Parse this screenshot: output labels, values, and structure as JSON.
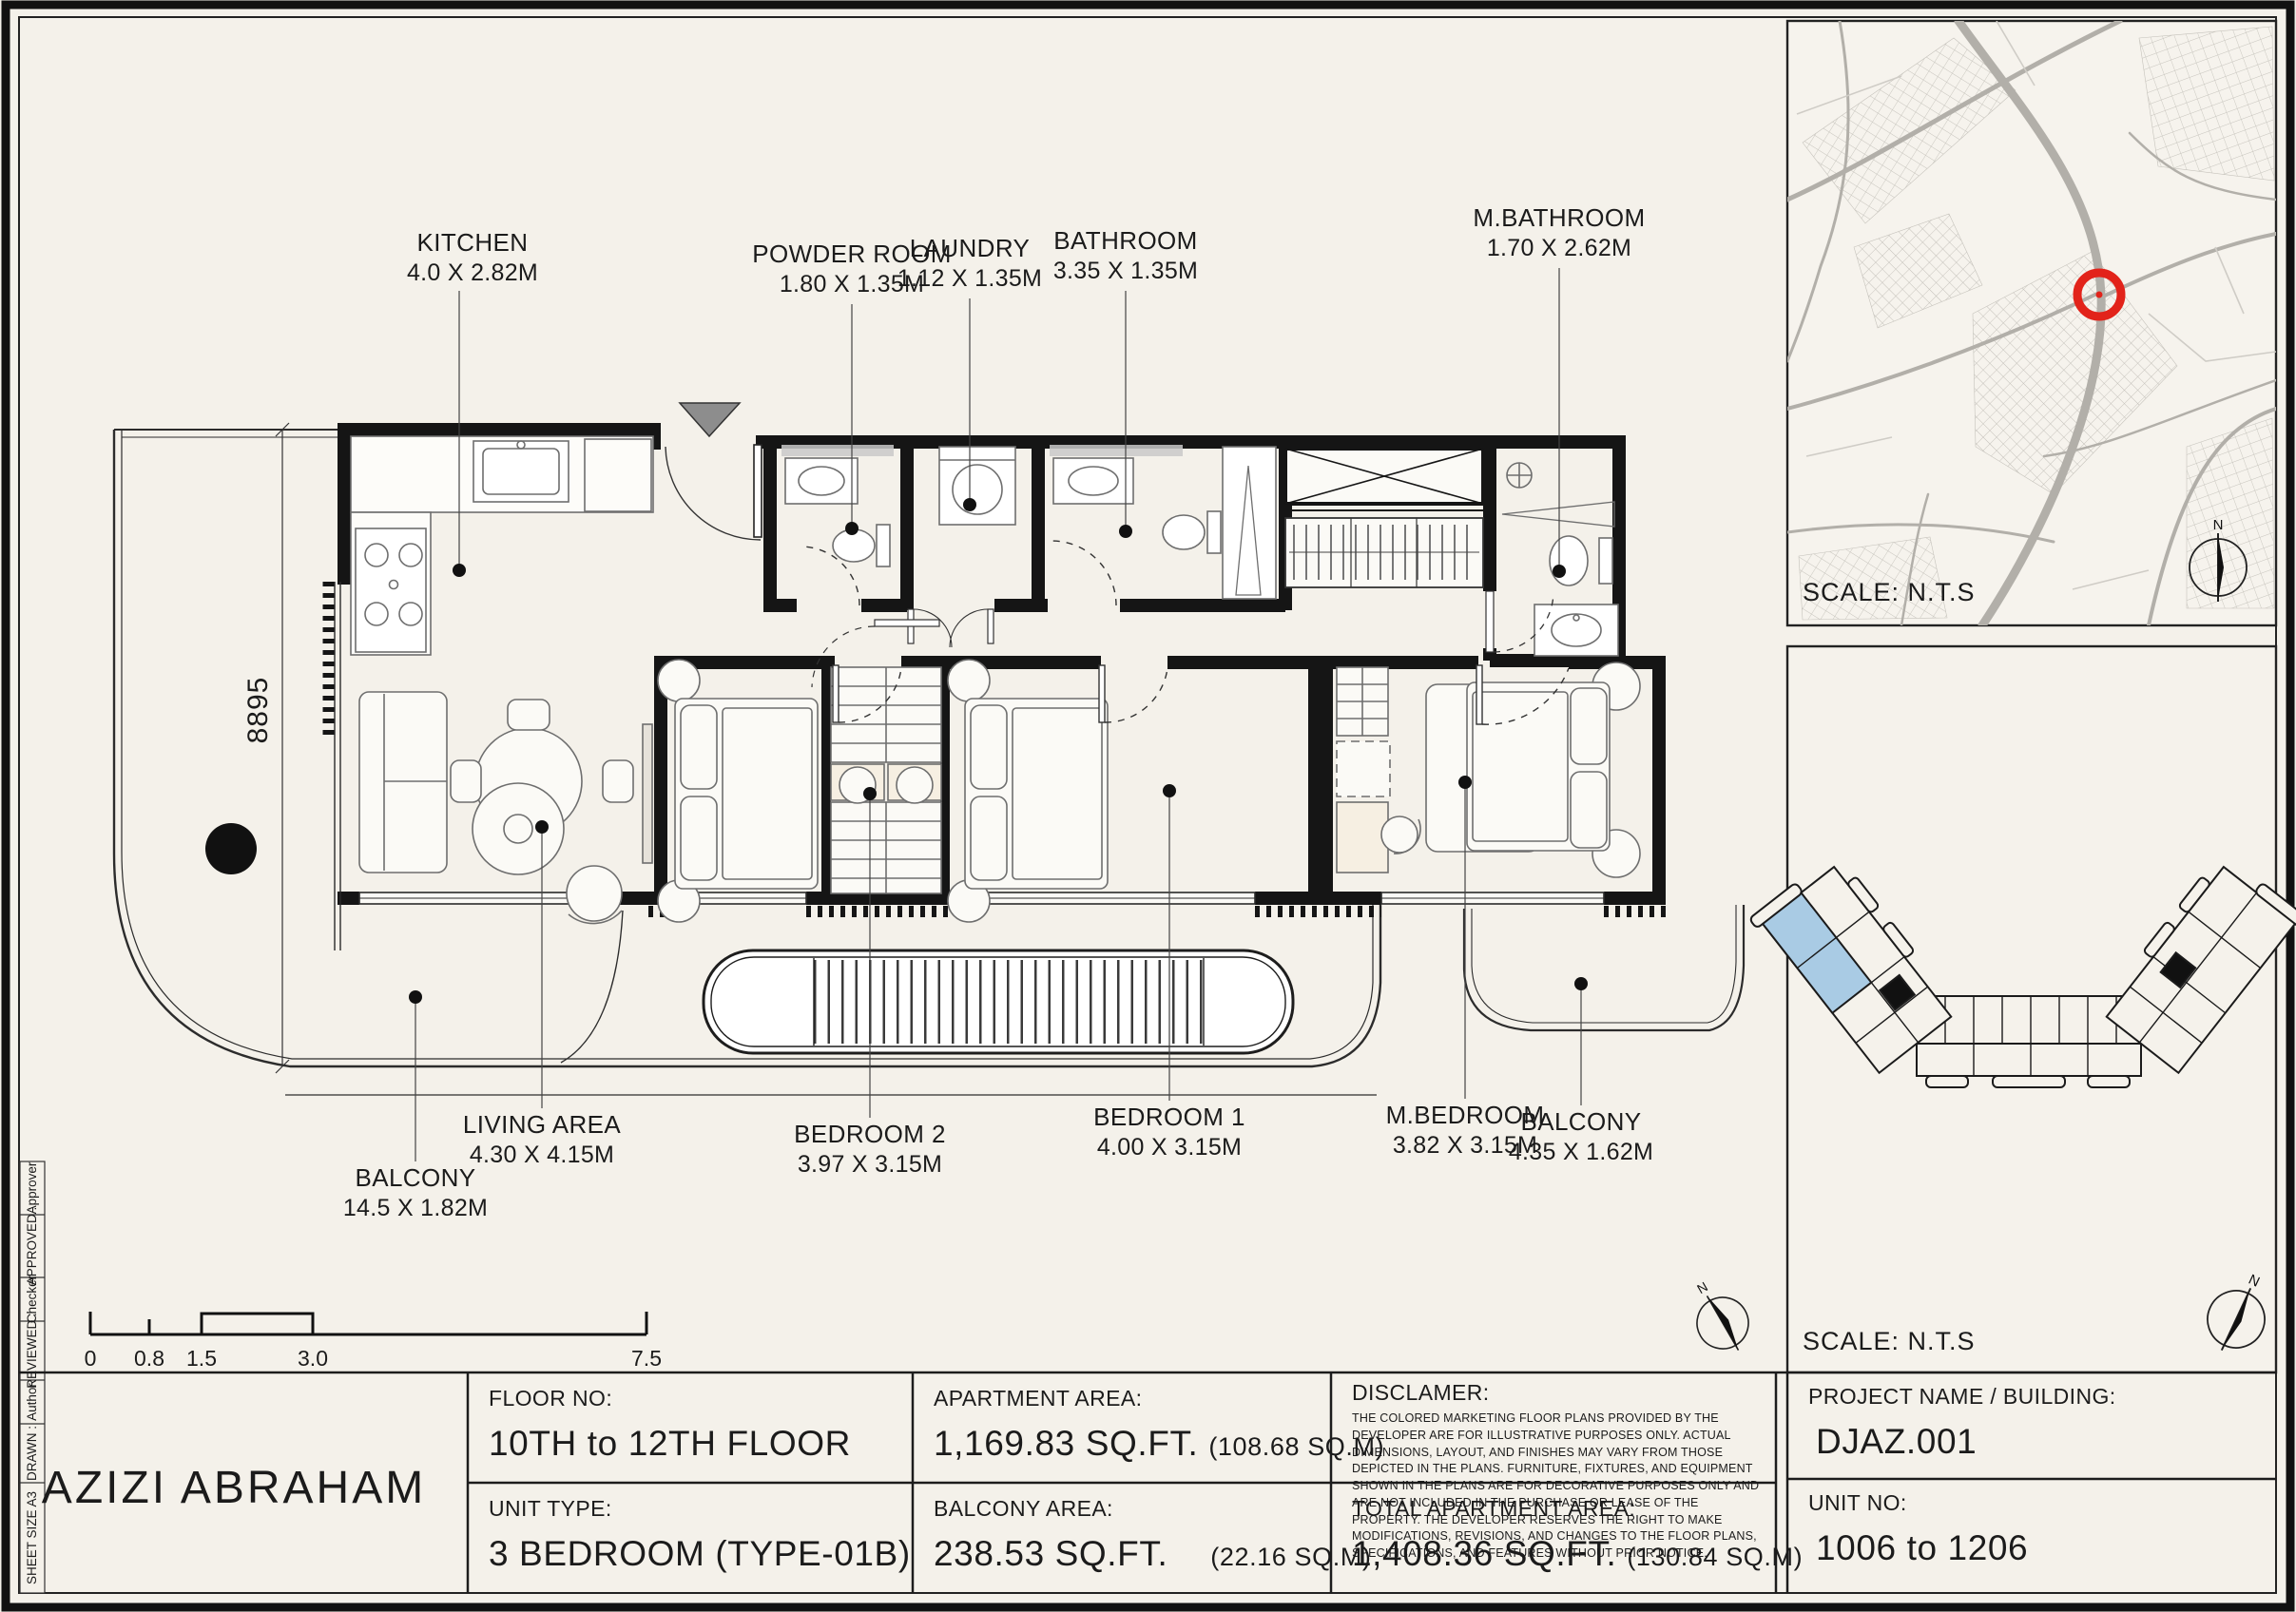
{
  "colors": {
    "paper": "#f4f1ea",
    "ink": "#1b1b1b",
    "marker_red": "#e2231a",
    "unit_blue": "#a9cbe4",
    "street_gray": "#b2afa9"
  },
  "plan": {
    "labels": [
      {
        "name": "KITCHEN",
        "dims": "4.0 X 2.82M"
      },
      {
        "name": "POWDER ROOM",
        "dims": "1.80 X 1.35M"
      },
      {
        "name": "LAUNDRY",
        "dims": "1.12 X 1.35M"
      },
      {
        "name": "BATHROOM",
        "dims": "3.35 X 1.35M"
      },
      {
        "name": "M.BATHROOM",
        "dims": "1.70 X 2.62M"
      },
      {
        "name": "BALCONY",
        "dims": "14.5 X 1.82M"
      },
      {
        "name": "LIVING AREA",
        "dims": "4.30 X 4.15M"
      },
      {
        "name": "BEDROOM 2",
        "dims": "3.97 X 3.15M"
      },
      {
        "name": "BEDROOM 1",
        "dims": "4.00 X 3.15M"
      },
      {
        "name": "M.BEDROOM",
        "dims": "3.82 X 3.15M"
      },
      {
        "name": "BALCONY",
        "dims": "4.35 X 1.62M"
      }
    ],
    "dimension": "8895",
    "north": "N",
    "scale_bar": [
      "0",
      "0.8",
      "1.5",
      "3.0",
      "7.5"
    ]
  },
  "map_panel": {
    "scale": "SCALE: N.T.S",
    "north": "N"
  },
  "key_panel": {
    "scale": "SCALE: N.T.S",
    "north": "N"
  },
  "side_strip": [
    "SHEET SIZE A3",
    "DRAWN :",
    "Author",
    "REVIEWED :",
    "Checker",
    "APPROVED :",
    "Approver"
  ],
  "table": {
    "project_title": "AZIZI ABRAHAM",
    "floor_no_label": "FLOOR NO:",
    "floor_no_value": "10TH to 12TH FLOOR",
    "unit_type_label": "UNIT TYPE:",
    "unit_type_value": "3 BEDROOM (TYPE-01B)",
    "apartment_area_label": "APARTMENT AREA:",
    "apartment_area_value": "1,169.83 SQ.FT.",
    "apartment_area_metric": "(108.68 SQ.M)",
    "balcony_area_label": "BALCONY AREA:",
    "balcony_area_value": "238.53 SQ.FT.",
    "balcony_area_metric": "(22.16 SQ.M)",
    "disclaimer_label": "DISCLAMER:",
    "disclaimer_text": "THE COLORED MARKETING FLOOR PLANS PROVIDED BY THE DEVELOPER ARE FOR ILLUSTRATIVE PURPOSES ONLY. ACTUAL DIMENSIONS, LAYOUT, AND FINISHES MAY VARY FROM THOSE DEPICTED IN THE PLANS. FURNITURE, FIXTURES, AND EQUIPMENT SHOWN IN THE PLANS ARE FOR DECORATIVE PURPOSES ONLY AND ARE NOT INCLUDED IN THE PURCHASE OR LEASE OF THE PROPERTY. THE DEVELOPER RESERVES THE RIGHT TO MAKE MODIFICATIONS, REVISIONS, AND CHANGES TO THE FLOOR PLANS, SPECIFICATIONS, AND FEATURES WITHOUT PRIOR NOTICE.",
    "total_area_label": "TOTAL APARTMENT AREA:",
    "total_area_value": "1,408.36 SQ.FT.",
    "total_area_metric": "(130.84 SQ.M)",
    "project_name_label": "PROJECT NAME / BUILDING:",
    "project_name_value": "DJAZ.001",
    "unit_no_label": "UNIT NO:",
    "unit_no_value": "1006 to 1206"
  }
}
